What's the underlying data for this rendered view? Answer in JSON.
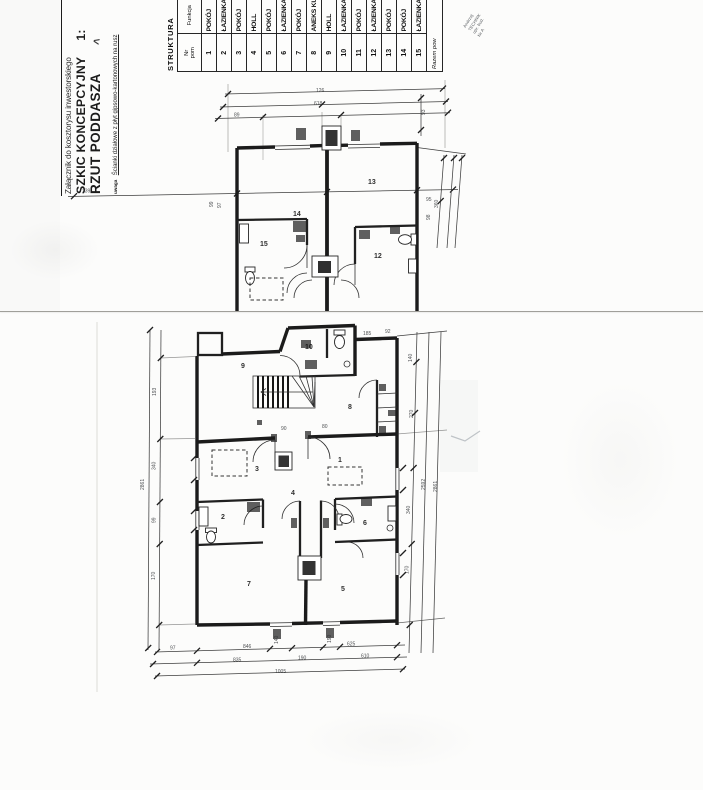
{
  "document": {
    "attachment": "Załącznik do kosztorysu inwestorskiego",
    "title": "SZKIC KONCEPCYJNY",
    "scale": "1:",
    "subtitle": "RZUT PODDASZA",
    "note_label": "uwaga",
    "note": "Ścianki działowe z płyt gipsowo-kartonowych na rusz"
  },
  "artifacts": {
    "mark": "<"
  },
  "stamp": {
    "line1": "Andrzej",
    "line2": "TECHNIK",
    "line3": "upr. bud.",
    "line4": "Nr A"
  },
  "table": {
    "title": "STRUKTURA",
    "col_nr_line1": "Nr",
    "col_nr_line2": "pom",
    "col_funkcja": "Funkcja",
    "rows": [
      {
        "nr": "1",
        "fn": "POKÓJ"
      },
      {
        "nr": "2",
        "fn": "ŁAZIENKA"
      },
      {
        "nr": "3",
        "fn": "POKÓJ"
      },
      {
        "nr": "4",
        "fn": "HOLL"
      },
      {
        "nr": "5",
        "fn": "POKÓJ"
      },
      {
        "nr": "6",
        "fn": "ŁAZIENKA"
      },
      {
        "nr": "7",
        "fn": "POKÓJ"
      },
      {
        "nr": "8",
        "fn": "ANEKS KUCHENNY"
      },
      {
        "nr": "9",
        "fn": "HOLL"
      },
      {
        "nr": "10",
        "fn": "ŁAZIENKA"
      },
      {
        "nr": "11",
        "fn": "POKÓJ"
      },
      {
        "nr": "12",
        "fn": "ŁAZIENKA"
      },
      {
        "nr": "13",
        "fn": "POKÓJ"
      },
      {
        "nr": "14",
        "fn": "POKÓJ"
      },
      {
        "nr": "15",
        "fn": "ŁAZIENKA"
      }
    ],
    "summary": "Razem pow"
  },
  "plans": {
    "upper": {
      "rooms": {
        "r12": "12",
        "r13": "13",
        "r14": "14",
        "r15": "15"
      },
      "dims": {
        "t1": "126",
        "t2": "618",
        "t3": "89",
        "l1": "139",
        "lw1": "99",
        "lw2": "97",
        "m1": "95",
        "r1": "93",
        "r2": "360",
        "r3": "98"
      }
    },
    "lower": {
      "rooms": {
        "r1": "1",
        "r2": "2",
        "r3": "3",
        "r4": "4",
        "r5": "5",
        "r6": "6",
        "r7": "7",
        "r8": "8",
        "r9": "9",
        "r10": "10"
      },
      "dims": {
        "b1": "97",
        "b2": "846",
        "b3": "625",
        "b4": "835",
        "b5": "190",
        "b6": "610",
        "b7": "1005",
        "l1": "193",
        "l2": "340",
        "l3": "99",
        "l4": "170",
        "l5": "2861",
        "r1": "140",
        "r2": "270",
        "r3": "340",
        "r4": "170",
        "r5": "2592",
        "r6": "2861",
        "t1": "185",
        "t2": "92",
        "o1": "140",
        "o2": "190",
        "i1": "90",
        "i2": "80"
      }
    }
  }
}
